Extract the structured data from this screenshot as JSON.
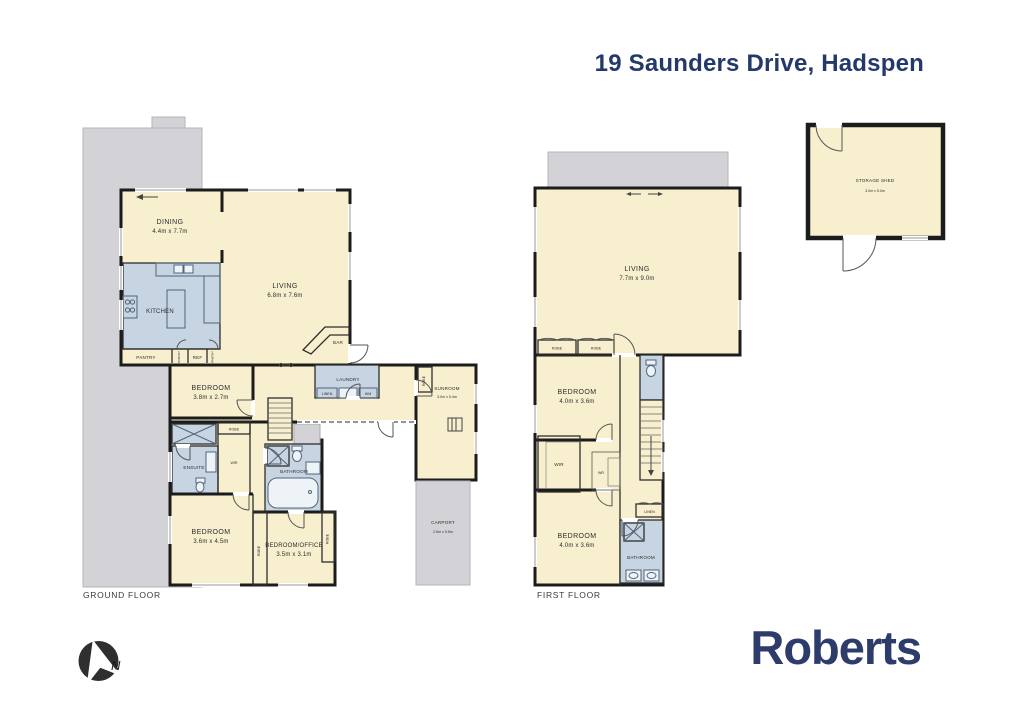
{
  "header": {
    "title": "19 Saunders Drive, Hadspen"
  },
  "brand": {
    "name": "Roberts"
  },
  "compass": {
    "label": "N"
  },
  "ground_floor": {
    "label": "GROUND FLOOR",
    "dining": {
      "name": "DINING",
      "dims": "4.4m x 7.7m"
    },
    "living": {
      "name": "LIVING",
      "dims": "6.8m x 7.6m"
    },
    "kitchen": {
      "name": "KITCHEN"
    },
    "pantry": {
      "name": "PANTRY"
    },
    "pantry_left": {
      "name": "PANTRY"
    },
    "ref": {
      "name": "REF"
    },
    "pantry_right": {
      "name": "PANTRY"
    },
    "bar": {
      "name": "BAR"
    },
    "bedroom1": {
      "name": "BEDROOM",
      "dims": "3.8m x 2.7m"
    },
    "robe1": {
      "name": "ROBE"
    },
    "laundry": {
      "name": "LAUNDRY"
    },
    "linen": {
      "name": "LINEN"
    },
    "wm": {
      "name": "WM"
    },
    "sunroom_robe": {
      "name": "ROBE"
    },
    "sunroom": {
      "name": "SUNROOM",
      "dims": "3.0m x 5.4m"
    },
    "ensuite": {
      "name": "ENSUITE"
    },
    "wir": {
      "name": "WIR"
    },
    "bathroom": {
      "name": "BATHROOM"
    },
    "bedroom2": {
      "name": "BEDROOM",
      "dims": "3.6m x 4.5m"
    },
    "bedroom_office": {
      "name": "BEDROOM/OFFICE",
      "dims": "3.5m x 3.1m"
    },
    "robe2": {
      "name": "ROBE"
    },
    "robe3": {
      "name": "ROBE"
    },
    "carport": {
      "name": "CARPORT",
      "dims": "2.6m x 5.5m"
    }
  },
  "first_floor": {
    "label": "FIRST FLOOR",
    "living": {
      "name": "LIVING",
      "dims": "7.7m x 9.0m"
    },
    "robe1": {
      "name": "ROBE"
    },
    "robe2": {
      "name": "ROBE"
    },
    "bedroom1": {
      "name": "BEDROOM",
      "dims": "4.0m x 3.6m"
    },
    "wir": {
      "name": "WIR"
    },
    "wr": {
      "name": "WR"
    },
    "bedroom2": {
      "name": "BEDROOM",
      "dims": "4.0m x 3.6m"
    },
    "linen": {
      "name": "LINEN"
    },
    "bathroom": {
      "name": "BATHROOM"
    }
  },
  "outbuildings": {
    "storage_shed": {
      "name": "STORAGE SHED",
      "dims": "3.0m x 5.0m"
    }
  },
  "colors": {
    "room_fill": "#f8efcf",
    "wet_area_fill": "#c7d4e2",
    "paved_fill": "#d3d3d7",
    "wall": "#1c1c1c",
    "brand_navy": "#2d3c6a",
    "title_navy": "#24396b"
  }
}
